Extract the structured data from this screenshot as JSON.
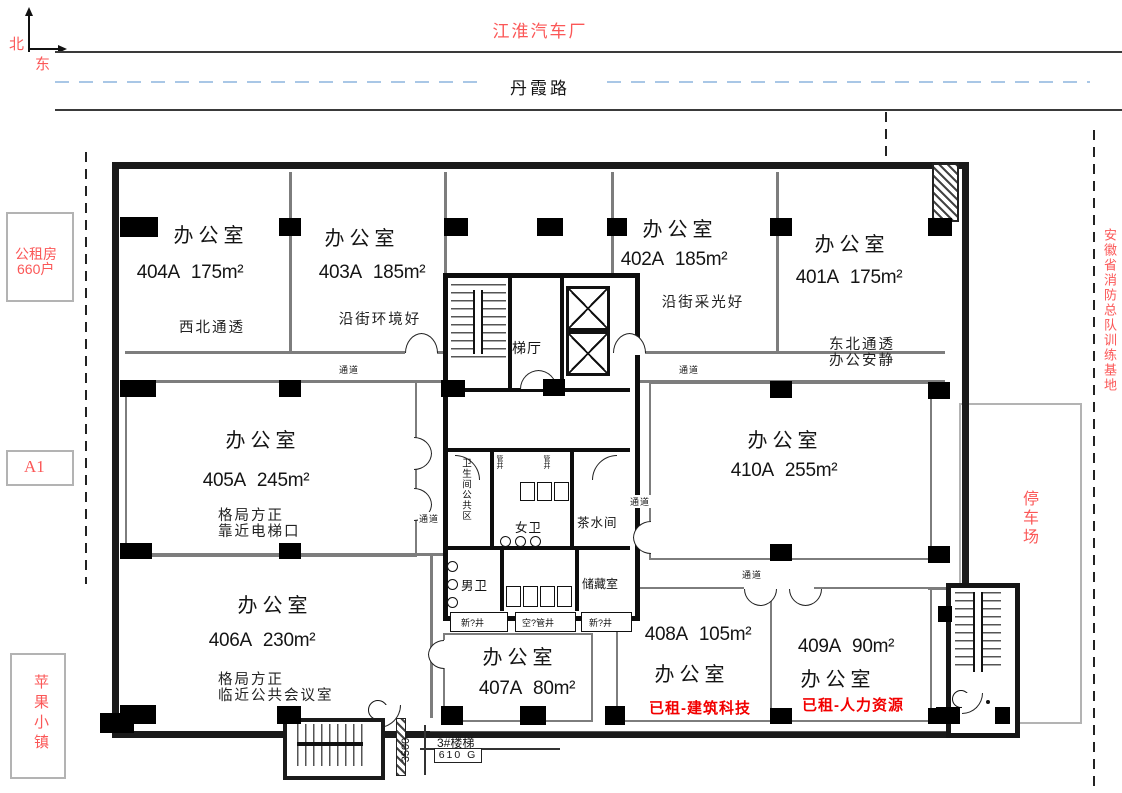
{
  "compass": {
    "north": "北",
    "east": "东"
  },
  "context": {
    "factory": "江淮汽车厂",
    "road": "丹霞路",
    "public_housing_line1": "公租房",
    "public_housing_line2": "660户",
    "block_a1": "A1",
    "apple_town": "苹果小镇",
    "fire_base": "安徽省消防总队训练基地",
    "parking": "停车场"
  },
  "rooms": [
    {
      "id": "404A",
      "type": "办公室",
      "area": "175m²",
      "desc1": "西北通透"
    },
    {
      "id": "403A",
      "type": "办公室",
      "area": "185m²",
      "desc1": "沿街环境好"
    },
    {
      "id": "402A",
      "type": "办公室",
      "area": "185m²",
      "desc1": "沿街采光好"
    },
    {
      "id": "401A",
      "type": "办公室",
      "area": "175m²",
      "desc1": "东北通透",
      "desc2": "办公安静"
    },
    {
      "id": "405A",
      "type": "办公室",
      "area": "245m²",
      "desc1": "格局方正",
      "desc2": "靠近电梯口"
    },
    {
      "id": "410A",
      "type": "办公室",
      "area": "255m²"
    },
    {
      "id": "406A",
      "type": "办公室",
      "area": "230m²",
      "desc1": "格局方正",
      "desc2": "临近公共会议室"
    },
    {
      "id": "407A",
      "type": "办公室",
      "area": "80m²"
    },
    {
      "id": "408A",
      "type": "办公室",
      "area": "105m²",
      "status": "已租-建筑科技"
    },
    {
      "id": "409A",
      "type": "办公室",
      "area": "90m²",
      "status": "已租-人力资源"
    }
  ],
  "core": {
    "elevator_hall": "梯厅",
    "toilet_zone": "卫生间公共区",
    "women": "女卫",
    "men": "男卫",
    "tea_room": "茶水间",
    "storage": "储藏室",
    "shaft_fresh_1": "新?井",
    "shaft_duct": "空?管井",
    "shaft_fresh_2": "新?井",
    "riser": "管井"
  },
  "labels": {
    "corridor": "通道",
    "stair3": "3#楼梯",
    "stair3_tag": "610 G",
    "dim_3500": "3500"
  },
  "colors": {
    "red_accent": "#fb5757",
    "red_strong": "#f20000",
    "road_dash": "#a9c7e6",
    "outer_wall": "#1a1a1a",
    "partition": "#7d7d7d"
  }
}
